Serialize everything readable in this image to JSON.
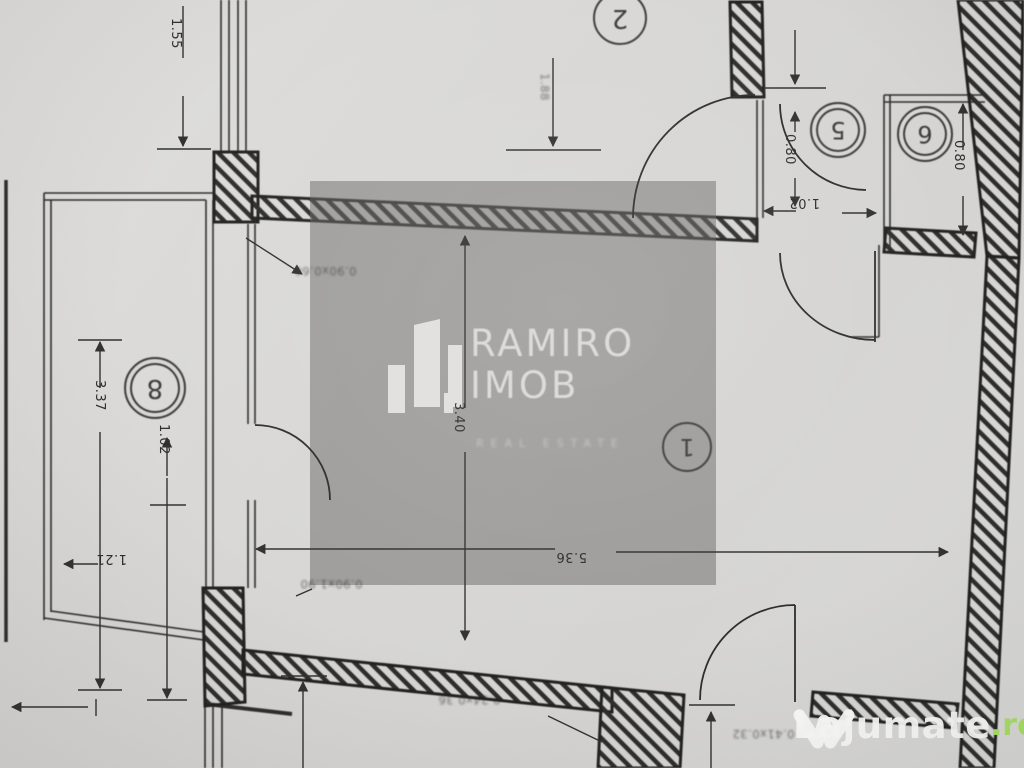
{
  "plan": {
    "description_label": "scanned apartment floor plan, photographed rotated 180 degrees"
  },
  "rooms": {
    "r1": "1",
    "r2": "2",
    "r5": "5",
    "r6": "6",
    "r8": "8"
  },
  "dims": {
    "d155": "1.55",
    "dtc": "1.88",
    "d337": "3.37",
    "d102_left": "1.02",
    "d121": "1.21",
    "d340": "3.40",
    "d536": "5.36",
    "d102_top": "1.02",
    "d080_room5": "0.80",
    "d080_room6": "0.80"
  },
  "annotations": {
    "a1": "0.90x0.60",
    "a2": "0.90x1.90",
    "a3": "0.24x0.36",
    "a4": "0.41x0.32"
  },
  "watermark": {
    "name_line1": "RAMIRO",
    "name_line2": "IMOB",
    "tagline": "REAL ESTATE"
  },
  "brand": {
    "name": "Lajumate",
    "tld": ".ro"
  },
  "colors": {
    "paper": "#d9d8d6",
    "ink": "#262626",
    "watermark_overlay": "rgba(104,102,100,0.5)",
    "watermark_text": "#dbd9d6",
    "logo_white": "#fafaf9",
    "logo_green": "#a9e067"
  }
}
